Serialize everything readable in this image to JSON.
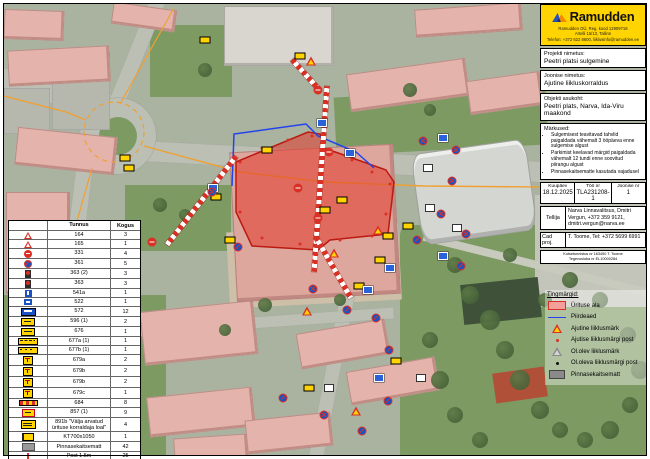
{
  "brand": {
    "name": "Ramudden",
    "info_line1": "Ramudden OÜ, Reg. kood 12909718",
    "info_line2": "Artelli 15/13, Tallinn",
    "info_line3": "Telefon: +372 622 8600, liiklusinfo@ramudden.ee"
  },
  "panel": {
    "project_label": "Projekti nimetus:",
    "project_value": "Peetri platsi sulgemine",
    "drawing_label": "Joonise nimetus:",
    "drawing_value": "Ajutine liikluskorraldus",
    "location_label": "Objekti asukoht:",
    "location_value": "Peetri plats, Narva, Ida-Viru maakond",
    "notes_label": "Märkused:",
    "notes": [
      "Sulgemisest teavitavad tahvlid paigaldada vähemalt 3 ööpäeva enne sulgemise algust",
      "Parkimist keelavad märgid paigaldada vähemalt 12 tundi enne soovitud piirangu algust",
      "Pinnasekaitsematte kasutada vajadusel"
    ],
    "meta": {
      "date_label": "Kuupäev",
      "date": "18.12.2025",
      "work_label": "Töö nr",
      "work": "TLA231208-1",
      "sheet_label": "Joonise nr",
      "sheet": "1"
    },
    "client_label": "Tellija",
    "client_value": "Narva Linnavalitsus, Dmitri Vergun, +372 359 9121, dmitri.vergun@narva.ee",
    "cad_label": "Cad proj.",
    "cad_value": "T. Toome, Tel: +372 5699 6991",
    "cert_line1": "Kutsetunnistus nr 163450 T. Toome",
    "cert_line2": "Tegevusluba nr EL10000284"
  },
  "sign_table": {
    "col_code": "Tunnus",
    "col_qty": "Kogus",
    "rows": [
      {
        "icon": "tri-roadworks",
        "code": "164",
        "qty": "3"
      },
      {
        "icon": "tri-warning",
        "code": "165",
        "qty": "1"
      },
      {
        "icon": "no-entry",
        "code": "331",
        "qty": "4"
      },
      {
        "icon": "no-stopping",
        "code": "361",
        "qty": "5"
      },
      {
        "icon": "no-parking-sign",
        "code": "363 (2)",
        "qty": "3"
      },
      {
        "icon": "no-parking-sign",
        "code": "363",
        "qty": "3"
      },
      {
        "icon": "blue-arrow",
        "code": "541a",
        "qty": "1"
      },
      {
        "icon": "blue-rect",
        "code": "522",
        "qty": "1"
      },
      {
        "icon": "blue-panel",
        "code": "572",
        "qty": "12"
      },
      {
        "icon": "yellow-panel",
        "code": "596 (1)",
        "qty": "2"
      },
      {
        "icon": "yellow-arrow-panel",
        "code": "676",
        "qty": "1"
      },
      {
        "icon": "yellow-bar",
        "code": "677a (1)",
        "qty": "1"
      },
      {
        "icon": "yellow-bar-dashed",
        "code": "677b (1)",
        "qty": "1"
      },
      {
        "icon": "yellow-plate",
        "code": "679a",
        "qty": "2"
      },
      {
        "icon": "yellow-plate",
        "code": "679b",
        "qty": "2"
      },
      {
        "icon": "yellow-plate",
        "code": "679b",
        "qty": "2"
      },
      {
        "icon": "yellow-plate",
        "code": "679c",
        "qty": "1"
      },
      {
        "icon": "stripe-bar",
        "code": "684",
        "qty": "8"
      },
      {
        "icon": "yellow-plate-red",
        "code": "857 (1)",
        "qty": "9"
      },
      {
        "icon": "yellow-text-plate",
        "code": "891b \"Välja arvatud ürituse korraldaja loal\"",
        "qty": "4"
      },
      {
        "icon": "kt-board",
        "code": "KT700x1050",
        "qty": "1"
      },
      {
        "icon": "gray-mat",
        "code": "Pinnasekaitsematt",
        "qty": "42"
      },
      {
        "icon": "post-red",
        "code": "Post 1.5m",
        "qty": "25"
      },
      {
        "icon": "post-blue",
        "code": "Post 2m",
        "qty": "10"
      },
      {
        "icon": "fence-line",
        "code": "Piirdeaed",
        "qty": "174jm"
      }
    ]
  },
  "map_key": {
    "title": "Tingmärgid:",
    "items": [
      {
        "symbol": "area-pink",
        "label": "Ürituse ala"
      },
      {
        "symbol": "fence-blue",
        "label": "Piirdeaed"
      },
      {
        "symbol": "tri-red",
        "label": "Ajutine liiklusmärk"
      },
      {
        "symbol": "dot-red",
        "label": "Ajutise liiklusmärgi post"
      },
      {
        "symbol": "tri-gray",
        "label": "Ol.olev liiklusmärk"
      },
      {
        "symbol": "dot-black",
        "label": "Ol.oleva liiklusmärgi post"
      },
      {
        "symbol": "rect-gray",
        "label": "Pinnasekaitsematt"
      }
    ]
  },
  "colors": {
    "accent_yellow": "#ffd400",
    "event_area_red": "#d93025",
    "fence_blue": "#2244ee",
    "road_line_orange": "#f0a030"
  }
}
